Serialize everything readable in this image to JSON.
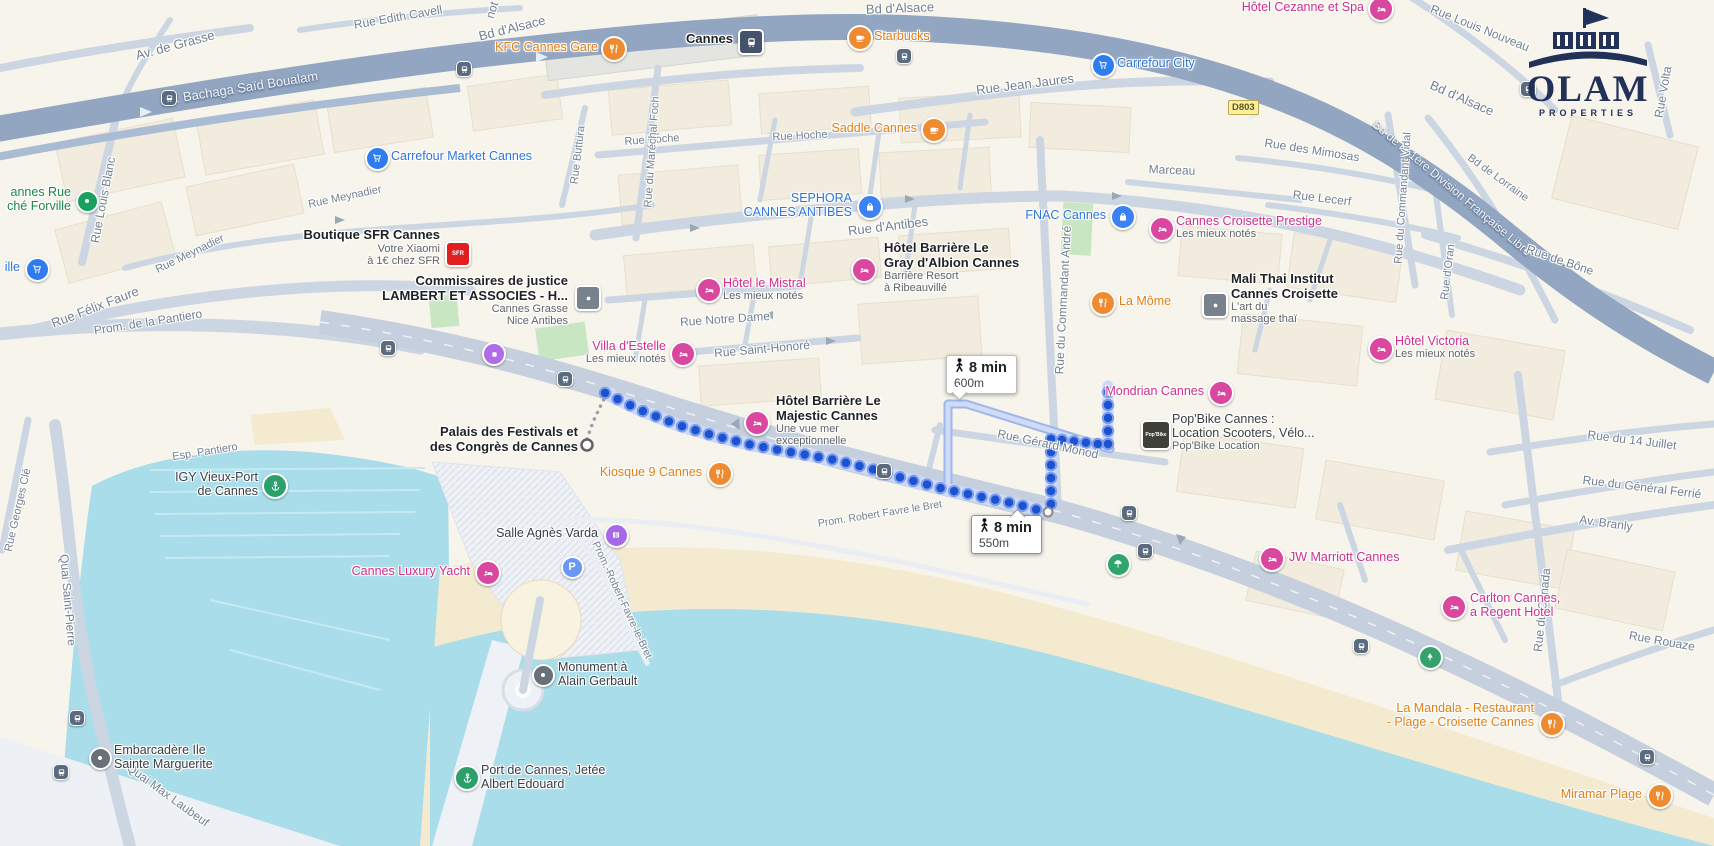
{
  "branding": {
    "logo_title": "OLAM",
    "logo_subtitle": "PROPERTIES"
  },
  "road_shield": {
    "label": "D803"
  },
  "route": {
    "origin": "Palais des Festivals et des Congrès de Cannes",
    "destination": "Mondrian Cannes",
    "badges": [
      {
        "duration": "8 min",
        "distance": "600m"
      },
      {
        "duration": "8 min",
        "distance": "550m"
      }
    ],
    "colors": {
      "dot": "#1a52cf",
      "dot_ring": "#7d9cec",
      "casing": "#ccd9f8",
      "alt_outer": "#9fb6e9",
      "alt_inner": "#cfdbf7"
    },
    "geometry": {
      "main": [
        [
          605,
          393
        ],
        [
          640,
          410
        ],
        [
          678,
          425
        ],
        [
          715,
          436
        ],
        [
          752,
          445
        ],
        [
          790,
          452
        ],
        [
          830,
          459
        ],
        [
          868,
          468
        ],
        [
          906,
          479
        ],
        [
          944,
          489
        ],
        [
          982,
          497
        ],
        [
          1016,
          504
        ],
        [
          1042,
          511
        ]
      ],
      "branch_a": [
        [
          1051,
          504
        ],
        [
          1051,
          438
        ]
      ],
      "monod_link": [
        [
          1062,
          440
        ],
        [
          1098,
          444
        ]
      ],
      "branch_b": [
        [
          1108,
          444
        ],
        [
          1108,
          386
        ]
      ],
      "alternative": [
        [
          948,
          490
        ],
        [
          948,
          404
        ],
        [
          966,
          404
        ],
        [
          1110,
          449
        ]
      ],
      "connector": [
        [
          587,
          439
        ],
        [
          593,
          422
        ],
        [
          600,
          407
        ],
        [
          606,
          395
        ]
      ],
      "origin_point": [
        587,
        445
      ],
      "via_point": [
        1048,
        512
      ]
    }
  },
  "street_labels": [
    {
      "t": "Av. de Grasse",
      "x": 175,
      "y": 45,
      "r": -15,
      "v": "g",
      "s": 13
    },
    {
      "t": "Rue Edith Cavell",
      "x": 398,
      "y": 17,
      "r": -10,
      "v": "g",
      "s": 12
    },
    {
      "t": "not",
      "x": 492,
      "y": 10,
      "r": -72,
      "v": "g",
      "s": 12
    },
    {
      "t": "Bd d'Alsace",
      "x": 512,
      "y": 28,
      "r": -14,
      "v": "g",
      "s": 13
    },
    {
      "t": "Bd d'Alsace",
      "x": 900,
      "y": 8,
      "r": -2,
      "v": "g",
      "s": 13
    },
    {
      "t": "Bd d'Alsace",
      "x": 1462,
      "y": 98,
      "r": 24,
      "v": "g",
      "s": 13
    },
    {
      "t": "Av. Bachaga Saïd Boualam",
      "x": 240,
      "y": 88,
      "r": -9,
      "v": "w",
      "s": 13
    },
    {
      "t": "Bd de la 1ère Division Française Libre",
      "x": 1452,
      "y": 188,
      "r": 40,
      "v": "w",
      "s": 12
    },
    {
      "t": "Rue Jean Jaures",
      "x": 1025,
      "y": 84,
      "r": -7,
      "v": "g",
      "s": 13
    },
    {
      "t": "Rue Hoche",
      "x": 652,
      "y": 140,
      "r": -4,
      "v": "g",
      "s": 11
    },
    {
      "t": "Rue Hoche",
      "x": 800,
      "y": 136,
      "r": -3,
      "v": "g",
      "s": 11
    },
    {
      "t": "Rue Buttura",
      "x": 578,
      "y": 155,
      "r": -83,
      "v": "g",
      "s": 11
    },
    {
      "t": "Rue du Maréchal Foch",
      "x": 652,
      "y": 152,
      "r": -86,
      "v": "g",
      "s": 11
    },
    {
      "t": "Rue d'Antibes",
      "x": 888,
      "y": 226,
      "r": -7,
      "v": "g",
      "s": 13
    },
    {
      "t": "Rue Meynadier",
      "x": 345,
      "y": 197,
      "r": -12,
      "v": "g",
      "s": 11
    },
    {
      "t": "Rue Meynadier",
      "x": 190,
      "y": 254,
      "r": -26,
      "v": "g",
      "s": 11
    },
    {
      "t": "Rue Louis Blanc",
      "x": 103,
      "y": 200,
      "r": -79,
      "v": "g",
      "s": 12
    },
    {
      "t": "Rue Félix Faure",
      "x": 95,
      "y": 307,
      "r": -21,
      "v": "g",
      "s": 13
    },
    {
      "t": "Prom. de la Pantiero",
      "x": 148,
      "y": 322,
      "r": -9,
      "v": "g",
      "s": 12
    },
    {
      "t": "Esp. Pantiero",
      "x": 205,
      "y": 452,
      "r": -9,
      "v": "g",
      "s": 11
    },
    {
      "t": "Rue Notre Dame",
      "x": 725,
      "y": 319,
      "r": -4,
      "v": "g",
      "s": 12
    },
    {
      "t": "Rue Saint-Honoré",
      "x": 762,
      "y": 349,
      "r": -5,
      "v": "g",
      "s": 12
    },
    {
      "t": "Rue du Commandant André",
      "x": 1063,
      "y": 300,
      "r": -87,
      "v": "g",
      "s": 12
    },
    {
      "t": "Rue Gérard Monod",
      "x": 1048,
      "y": 444,
      "r": 12,
      "v": "g",
      "s": 12
    },
    {
      "t": "Rue de Bône",
      "x": 1560,
      "y": 260,
      "r": 19,
      "v": "g",
      "s": 12
    },
    {
      "t": "Rue d'Oran",
      "x": 1448,
      "y": 272,
      "r": -83,
      "v": "g",
      "s": 11
    },
    {
      "t": "Bd de Lorraine",
      "x": 1498,
      "y": 178,
      "r": 36,
      "v": "g",
      "s": 11
    },
    {
      "t": "Rue des Mimosas",
      "x": 1312,
      "y": 150,
      "r": 9,
      "v": "g",
      "s": 12
    },
    {
      "t": "Rue Lecerf",
      "x": 1322,
      "y": 198,
      "r": 7,
      "v": "g",
      "s": 12
    },
    {
      "t": "Marceau",
      "x": 1172,
      "y": 170,
      "r": 2,
      "v": "g",
      "s": 12
    },
    {
      "t": "Rue Louis Nouveau",
      "x": 1480,
      "y": 28,
      "r": 22,
      "v": "g",
      "s": 12
    },
    {
      "t": "Rue Volta",
      "x": 1663,
      "y": 92,
      "r": -80,
      "v": "g",
      "s": 12
    },
    {
      "t": "Rue du Commandant Vidal",
      "x": 1403,
      "y": 198,
      "r": -86,
      "v": "g",
      "s": 11
    },
    {
      "t": "Rue du 14 Juillet",
      "x": 1632,
      "y": 440,
      "r": 7,
      "v": "g",
      "s": 12
    },
    {
      "t": "Rue du Général Ferrié",
      "x": 1642,
      "y": 487,
      "r": 7,
      "v": "g",
      "s": 12
    },
    {
      "t": "Av. Branly",
      "x": 1606,
      "y": 523,
      "r": 8,
      "v": "g",
      "s": 12
    },
    {
      "t": "Rue Rouaze",
      "x": 1662,
      "y": 641,
      "r": 10,
      "v": "g",
      "s": 12
    },
    {
      "t": "Rue du Canada",
      "x": 1542,
      "y": 610,
      "r": -84,
      "v": "g",
      "s": 12
    },
    {
      "t": "Quai Saint-Pierre",
      "x": 68,
      "y": 600,
      "r": 85,
      "v": "g",
      "s": 12
    },
    {
      "t": "Quai Max Laubeuf",
      "x": 168,
      "y": 795,
      "r": 36,
      "v": "g",
      "s": 12
    },
    {
      "t": "Rue Georges Clé",
      "x": 18,
      "y": 510,
      "r": -77,
      "v": "g",
      "s": 11
    },
    {
      "t": "Prom. Robert Favre le Bret",
      "x": 880,
      "y": 514,
      "r": -9,
      "v": "g",
      "s": 10.5
    },
    {
      "t": "Prom.-Robert-Favre-le-Bret",
      "x": 622,
      "y": 600,
      "r": 65,
      "v": "g",
      "s": 10.5
    }
  ],
  "pois": [
    {
      "id": "kfc-cannes-gare",
      "icon": "restaurant",
      "ix": 612,
      "iy": 47,
      "side": "l",
      "lx": 598,
      "ly": 40,
      "lines": [
        {
          "t": "KFC Cannes Gare",
          "c": "orange"
        }
      ]
    },
    {
      "id": "cannes-station",
      "icon": "train",
      "ix": 749,
      "iy": 40,
      "side": "l",
      "lx": 733,
      "ly": 32,
      "lines": [
        {
          "t": "Cannes",
          "c": "darkbold"
        }
      ]
    },
    {
      "id": "starbucks",
      "icon": "cafe",
      "ix": 858,
      "iy": 36,
      "side": "r",
      "lx": 874,
      "ly": 29,
      "lines": [
        {
          "t": "Starbucks",
          "c": "orange"
        }
      ]
    },
    {
      "id": "carrefour-city",
      "icon": "cart",
      "ix": 1101,
      "iy": 63,
      "side": "r",
      "lx": 1117,
      "ly": 56,
      "lines": [
        {
          "t": "Carrefour City",
          "c": "blue"
        }
      ]
    },
    {
      "id": "hotel-cezanne",
      "icon": "hotel",
      "ix": 1379,
      "iy": 7,
      "side": "l",
      "lx": 1364,
      "ly": 0,
      "lines": [
        {
          "t": "Hôtel Cezanne et Spa",
          "c": "pink"
        }
      ]
    },
    {
      "id": "saddle-cannes",
      "icon": "cafe",
      "ix": 932,
      "iy": 128,
      "side": "l",
      "lx": 917,
      "ly": 121,
      "lines": [
        {
          "t": "Saddle Cannes",
          "c": "orange"
        }
      ]
    },
    {
      "id": "carrefour-market",
      "icon": "cart",
      "ix": 375,
      "iy": 156,
      "side": "r",
      "lx": 391,
      "ly": 149,
      "lines": [
        {
          "t": "Carrefour Market Cannes",
          "c": "blue"
        }
      ]
    },
    {
      "id": "marche-forville",
      "icon": "dot-green",
      "ix": 85,
      "iy": 199,
      "side": "l",
      "lx": 71,
      "ly": 185,
      "lines": [
        {
          "t": "annes Rue",
          "c": "green"
        },
        {
          "t": "ché Forville",
          "c": "green"
        }
      ]
    },
    {
      "id": "shop-west",
      "icon": "cart",
      "ix": 35,
      "iy": 267,
      "side": "l",
      "lx": 20,
      "ly": 260,
      "lines": [
        {
          "t": "ille",
          "c": "blue"
        }
      ]
    },
    {
      "id": "boutique-sfr",
      "icon": "sfr",
      "ix": 456,
      "iy": 252,
      "side": "l",
      "lx": 440,
      "ly": 228,
      "lines": [
        {
          "t": "Boutique SFR Cannes",
          "c": "darkbold"
        },
        {
          "t": "Votre Xiaomi",
          "c": "gray"
        },
        {
          "t": "à 1€ chez SFR",
          "c": "gray"
        }
      ]
    },
    {
      "id": "commissaires-justice",
      "icon": "square",
      "ix": 586,
      "iy": 296,
      "side": "l",
      "lx": 568,
      "ly": 274,
      "lines": [
        {
          "t": "Commissaires de justice",
          "c": "darkbold"
        },
        {
          "t": "LAMBERT ET ASSOCIES - H...",
          "c": "darkbold"
        },
        {
          "t": "Cannes Grasse",
          "c": "gray"
        },
        {
          "t": "Nice Antibes",
          "c": "gray"
        }
      ]
    },
    {
      "id": "sephora",
      "icon": "bag",
      "ix": 868,
      "iy": 205,
      "side": "l",
      "lx": 852,
      "ly": 191,
      "lines": [
        {
          "t": "SEPHORA",
          "c": "blue"
        },
        {
          "t": "CANNES ANTIBES",
          "c": "blue"
        }
      ]
    },
    {
      "id": "fnac-cannes",
      "icon": "bag",
      "ix": 1121,
      "iy": 215,
      "side": "l",
      "lx": 1106,
      "ly": 208,
      "lines": [
        {
          "t": "FNAC Cannes",
          "c": "blue"
        }
      ]
    },
    {
      "id": "croisette-prestige",
      "icon": "hotel",
      "ix": 1160,
      "iy": 227,
      "side": "r",
      "lx": 1176,
      "ly": 214,
      "lines": [
        {
          "t": "Cannes Croisette Prestige",
          "c": "pink"
        },
        {
          "t": "Les mieux notés",
          "c": "gray"
        }
      ]
    },
    {
      "id": "hotel-mistral",
      "icon": "hotel",
      "ix": 707,
      "iy": 288,
      "side": "r",
      "lx": 723,
      "ly": 276,
      "lines": [
        {
          "t": "Hôtel le Mistral",
          "c": "pink"
        },
        {
          "t": "Les mieux notés",
          "c": "gray"
        }
      ]
    },
    {
      "id": "gray-albion",
      "icon": "hotel",
      "ix": 862,
      "iy": 268,
      "side": "r",
      "lx": 884,
      "ly": 241,
      "lines": [
        {
          "t": "Hôtel Barrière Le",
          "c": "darkbold"
        },
        {
          "t": "Gray d'Albion Cannes",
          "c": "darkbold"
        },
        {
          "t": "Barrière Resort",
          "c": "gray"
        },
        {
          "t": "à Ribeauvillé",
          "c": "gray"
        }
      ]
    },
    {
      "id": "la-mome",
      "icon": "restaurant",
      "ix": 1101,
      "iy": 301,
      "side": "r",
      "lx": 1119,
      "ly": 294,
      "lines": [
        {
          "t": "La Môme",
          "c": "orange"
        }
      ]
    },
    {
      "id": "mali-thai",
      "icon": "square",
      "ix": 1213,
      "iy": 303,
      "side": "r",
      "lx": 1231,
      "ly": 272,
      "lines": [
        {
          "t": "Mali Thai Institut",
          "c": "darkbold"
        },
        {
          "t": "Cannes Croisette",
          "c": "darkbold"
        },
        {
          "t": "L'art du",
          "c": "gray"
        },
        {
          "t": "massage thaï",
          "c": "gray"
        }
      ]
    },
    {
      "id": "hotel-victoria",
      "icon": "hotel",
      "ix": 1379,
      "iy": 347,
      "side": "r",
      "lx": 1395,
      "ly": 334,
      "lines": [
        {
          "t": "Hôtel Victoria",
          "c": "pink"
        },
        {
          "t": "Les mieux notés",
          "c": "gray"
        }
      ]
    },
    {
      "id": "villa-destelle",
      "icon": "hotel",
      "ix": 681,
      "iy": 352,
      "side": "l",
      "lx": 666,
      "ly": 339,
      "lines": [
        {
          "t": "Villa d'Estelle",
          "c": "pink"
        },
        {
          "t": "Les mieux notés",
          "c": "gray"
        }
      ]
    },
    {
      "id": "attraction",
      "icon": "attraction",
      "ix": 492,
      "iy": 352,
      "side": "r",
      "lx": 0,
      "ly": 0,
      "lines": []
    },
    {
      "id": "majestic",
      "icon": "hotel",
      "ix": 755,
      "iy": 421,
      "side": "r",
      "lx": 776,
      "ly": 394,
      "lines": [
        {
          "t": "Hôtel Barrière Le",
          "c": "darkbold"
        },
        {
          "t": "Majestic Cannes",
          "c": "darkbold"
        },
        {
          "t": "Une vue mer",
          "c": "gray"
        },
        {
          "t": "exceptionnelle",
          "c": "gray"
        }
      ]
    },
    {
      "id": "mondrian",
      "icon": "hotel",
      "ix": 1219,
      "iy": 391,
      "side": "l",
      "lx": 1204,
      "ly": 384,
      "lines": [
        {
          "t": "Mondrian Cannes",
          "c": "pink"
        }
      ]
    },
    {
      "id": "popbike",
      "icon": "popbike",
      "ix": 1154,
      "iy": 433,
      "side": "r",
      "lx": 1172,
      "ly": 412,
      "lines": [
        {
          "t": "Pop'Bike Cannes :",
          "c": "dark"
        },
        {
          "t": "Location Scooters, Vélo...",
          "c": "dark"
        },
        {
          "t": "Pop'Bike Location",
          "c": "gray"
        }
      ]
    },
    {
      "id": "kiosque-9",
      "icon": "restaurant",
      "ix": 718,
      "iy": 472,
      "side": "l",
      "lx": 702,
      "ly": 465,
      "lines": [
        {
          "t": "Kiosque 9 Cannes",
          "c": "orange"
        }
      ]
    },
    {
      "id": "palais-festivals",
      "icon": "none",
      "ix": 0,
      "iy": 0,
      "side": "l",
      "lx": 578,
      "ly": 425,
      "lines": [
        {
          "t": "Palais des Festivals et",
          "c": "darkbold"
        },
        {
          "t": "des Congrès de Cannes",
          "c": "darkbold"
        }
      ]
    },
    {
      "id": "salle-agnes-varda",
      "icon": "theater",
      "ix": 614,
      "iy": 533,
      "side": "l",
      "lx": 598,
      "ly": 526,
      "lines": [
        {
          "t": "Salle Agnès Varda",
          "c": "dark"
        }
      ]
    },
    {
      "id": "parking",
      "icon": "parking",
      "ix": 570,
      "iy": 565,
      "side": "r",
      "lx": 0,
      "ly": 0,
      "lines": []
    },
    {
      "id": "cannes-luxury-yacht",
      "icon": "hotel",
      "ix": 486,
      "iy": 571,
      "side": "l",
      "lx": 470,
      "ly": 564,
      "lines": [
        {
          "t": "Cannes Luxury Yacht",
          "c": "pink"
        }
      ]
    },
    {
      "id": "igy-vieux-port",
      "icon": "anchor",
      "ix": 273,
      "iy": 484,
      "side": "l",
      "lx": 258,
      "ly": 470,
      "lines": [
        {
          "t": "IGY Vieux-Port",
          "c": "dark"
        },
        {
          "t": "de Cannes",
          "c": "dark"
        }
      ]
    },
    {
      "id": "monument-gerbault",
      "icon": "dot-gray",
      "ix": 541,
      "iy": 673,
      "side": "r",
      "lx": 558,
      "ly": 660,
      "lines": [
        {
          "t": "Monument à",
          "c": "dark"
        },
        {
          "t": "Alain Gerbault",
          "c": "dark"
        }
      ]
    },
    {
      "id": "embarcadere",
      "icon": "dot-gray",
      "ix": 98,
      "iy": 756,
      "side": "r",
      "lx": 114,
      "ly": 743,
      "lines": [
        {
          "t": "Embarcadère Ile",
          "c": "dark"
        },
        {
          "t": "Sainte Marguerite",
          "c": "dark"
        }
      ]
    },
    {
      "id": "port-jetee",
      "icon": "anchor",
      "ix": 465,
      "iy": 776,
      "side": "r",
      "lx": 481,
      "ly": 763,
      "lines": [
        {
          "t": "Port de Cannes, Jetée",
          "c": "dark"
        },
        {
          "t": "Albert Edouard",
          "c": "dark"
        }
      ]
    },
    {
      "id": "jw-marriott",
      "icon": "hotel",
      "ix": 1270,
      "iy": 557,
      "side": "r",
      "lx": 1289,
      "ly": 550,
      "lines": [
        {
          "t": "JW Marriott Cannes",
          "c": "pink"
        }
      ]
    },
    {
      "id": "carlton",
      "icon": "hotel",
      "ix": 1452,
      "iy": 605,
      "side": "r",
      "lx": 1470,
      "ly": 591,
      "lines": [
        {
          "t": "Carlton Cannes,",
          "c": "pink"
        },
        {
          "t": "a Regent Hotel",
          "c": "pink"
        }
      ]
    },
    {
      "id": "la-mandala",
      "icon": "restaurant",
      "ix": 1550,
      "iy": 722,
      "side": "l",
      "lx": 1534,
      "ly": 701,
      "lines": [
        {
          "t": "La Mandala - Restaurant",
          "c": "orange"
        },
        {
          "t": "- Plage - Croisette Cannes",
          "c": "orange"
        }
      ]
    },
    {
      "id": "miramar-plage",
      "icon": "restaurant",
      "ix": 1658,
      "iy": 794,
      "side": "l",
      "lx": 1642,
      "ly": 787,
      "lines": [
        {
          "t": "Miramar Plage",
          "c": "orange"
        }
      ]
    },
    {
      "id": "beach",
      "icon": "umbrella",
      "ix": 1116,
      "iy": 562,
      "side": "r",
      "lx": 0,
      "ly": 0,
      "lines": []
    },
    {
      "id": "tree",
      "icon": "tree",
      "ix": 1428,
      "iy": 655,
      "side": "r",
      "lx": 0,
      "ly": 0,
      "lines": []
    }
  ],
  "transit_stops": [
    [
      463,
      68
    ],
    [
      168,
      97
    ],
    [
      903,
      55
    ],
    [
      387,
      347
    ],
    [
      564,
      378
    ],
    [
      883,
      470
    ],
    [
      1128,
      512
    ],
    [
      1144,
      550
    ],
    [
      1360,
      645
    ],
    [
      1646,
      756
    ],
    [
      76,
      717
    ],
    [
      60,
      771
    ],
    [
      1527,
      88
    ]
  ]
}
